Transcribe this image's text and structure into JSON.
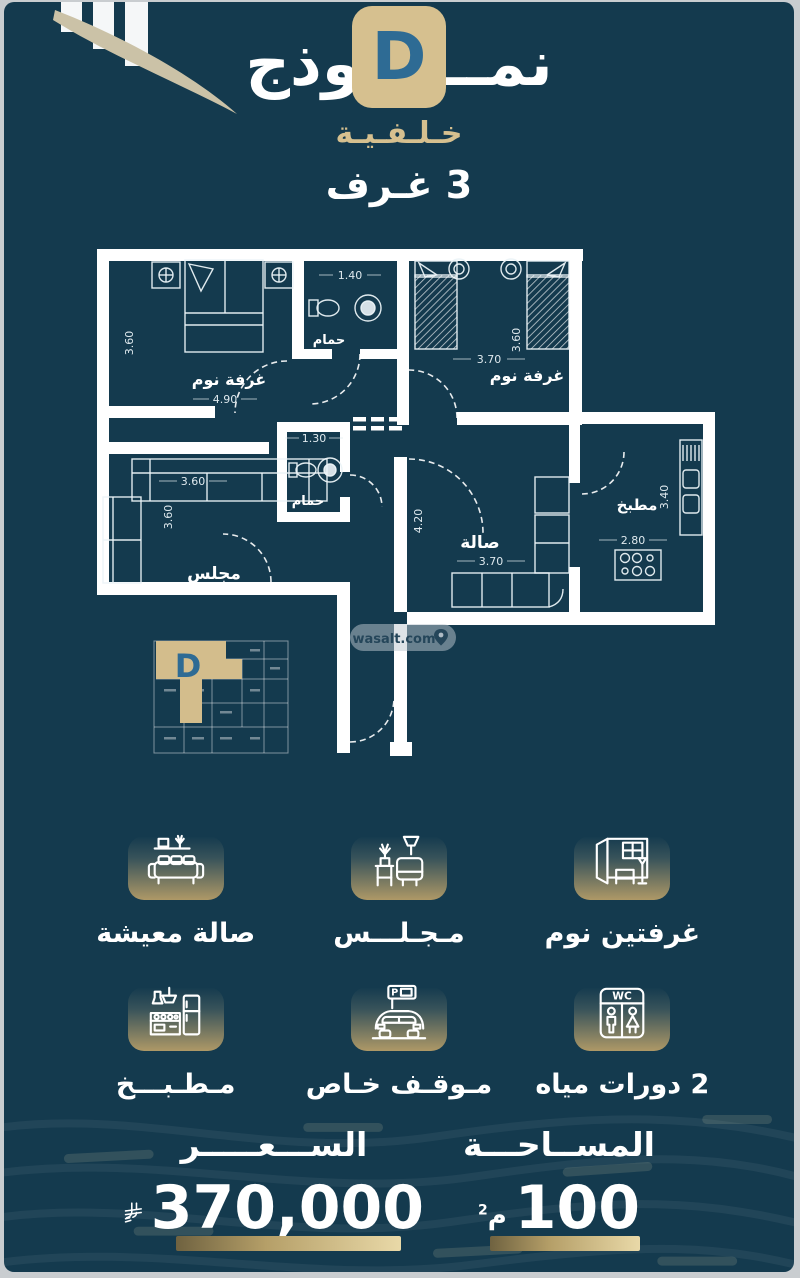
{
  "colors": {
    "background": "#143a4e",
    "accent_tan": "#d6c08f",
    "accent_blue": "#2e6b94",
    "line_white": "#ffffff",
    "gold_bar_light": "#e9d9a8"
  },
  "header": {
    "model_word": "نمــــــوذج",
    "model_letter": "D",
    "variant": "خـلـفـيـة",
    "rooms_line": "3 غـرف"
  },
  "plan": {
    "rooms": {
      "bedroom1": "غرفة نوم",
      "bath1": "حمام",
      "bedroom2": "غرفة نوم",
      "majlis": "مجلس",
      "bath2": "حمام",
      "hall": "صالة",
      "kitchen": "مطبخ"
    },
    "dims": {
      "bedroom1_h": "3.60",
      "bedroom1_w": "4.90",
      "bath1_w": "1.40",
      "bedroom2_w": "3.70",
      "bedroom2_h": "3.60",
      "bath2_w": "1.30",
      "majlis_w": "3.60",
      "majlis_h": "3.60",
      "hall_v": "4.20",
      "hall_w": "3.70",
      "kitchen_v": "3.40",
      "kitchen_w": "2.80"
    },
    "unit_marker": "D",
    "watermark": "wasalt.com"
  },
  "icons": {
    "wc": "WC",
    "parking": "P"
  },
  "features": [
    {
      "label": "غرفتين نوم"
    },
    {
      "label": "مـجـلـــس"
    },
    {
      "label": "صالة معيشة"
    },
    {
      "label": "2 دورات مياه"
    },
    {
      "label": "مـوقـف خـاص"
    },
    {
      "label": "مـطـبـــخ"
    }
  ],
  "footer": {
    "price_label": "الســـعـــــر",
    "price_value": "370,000",
    "area_label": "المســاحـــة",
    "area_value": "100",
    "area_unit": "م",
    "area_exp": "2"
  }
}
